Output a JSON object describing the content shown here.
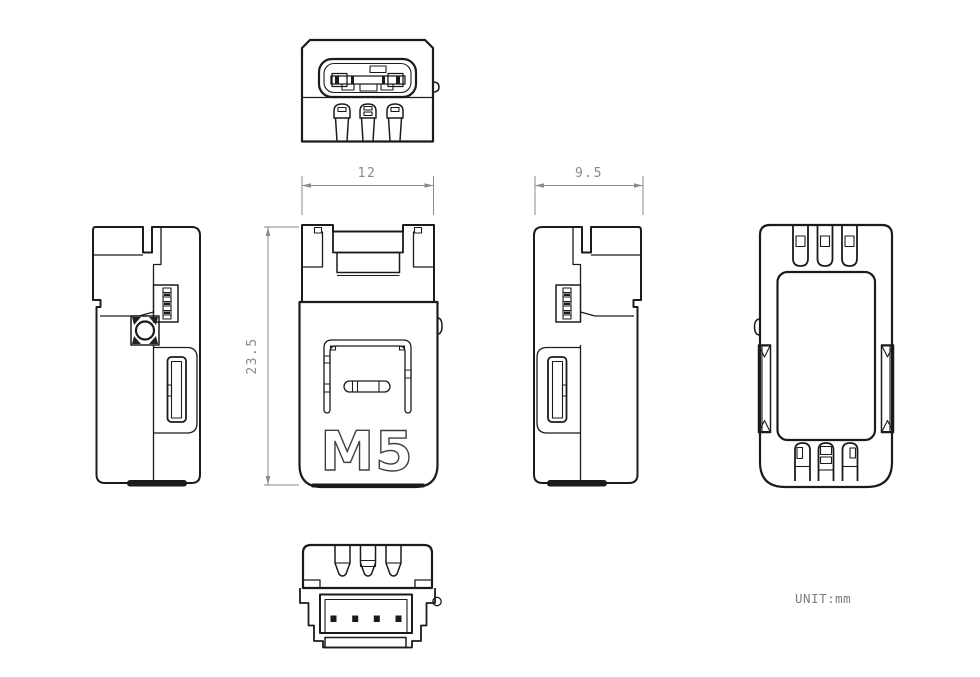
{
  "drawing": {
    "logo": "M5",
    "unit_label": "UNIT:mm",
    "dimensions": {
      "width": "12",
      "height": "23.5",
      "depth": "9.5"
    },
    "colors": {
      "line": "#1b1b1b",
      "dimension": "#8a8a8a",
      "background": "#ffffff",
      "logo_outline": "#3f3f3f"
    }
  }
}
